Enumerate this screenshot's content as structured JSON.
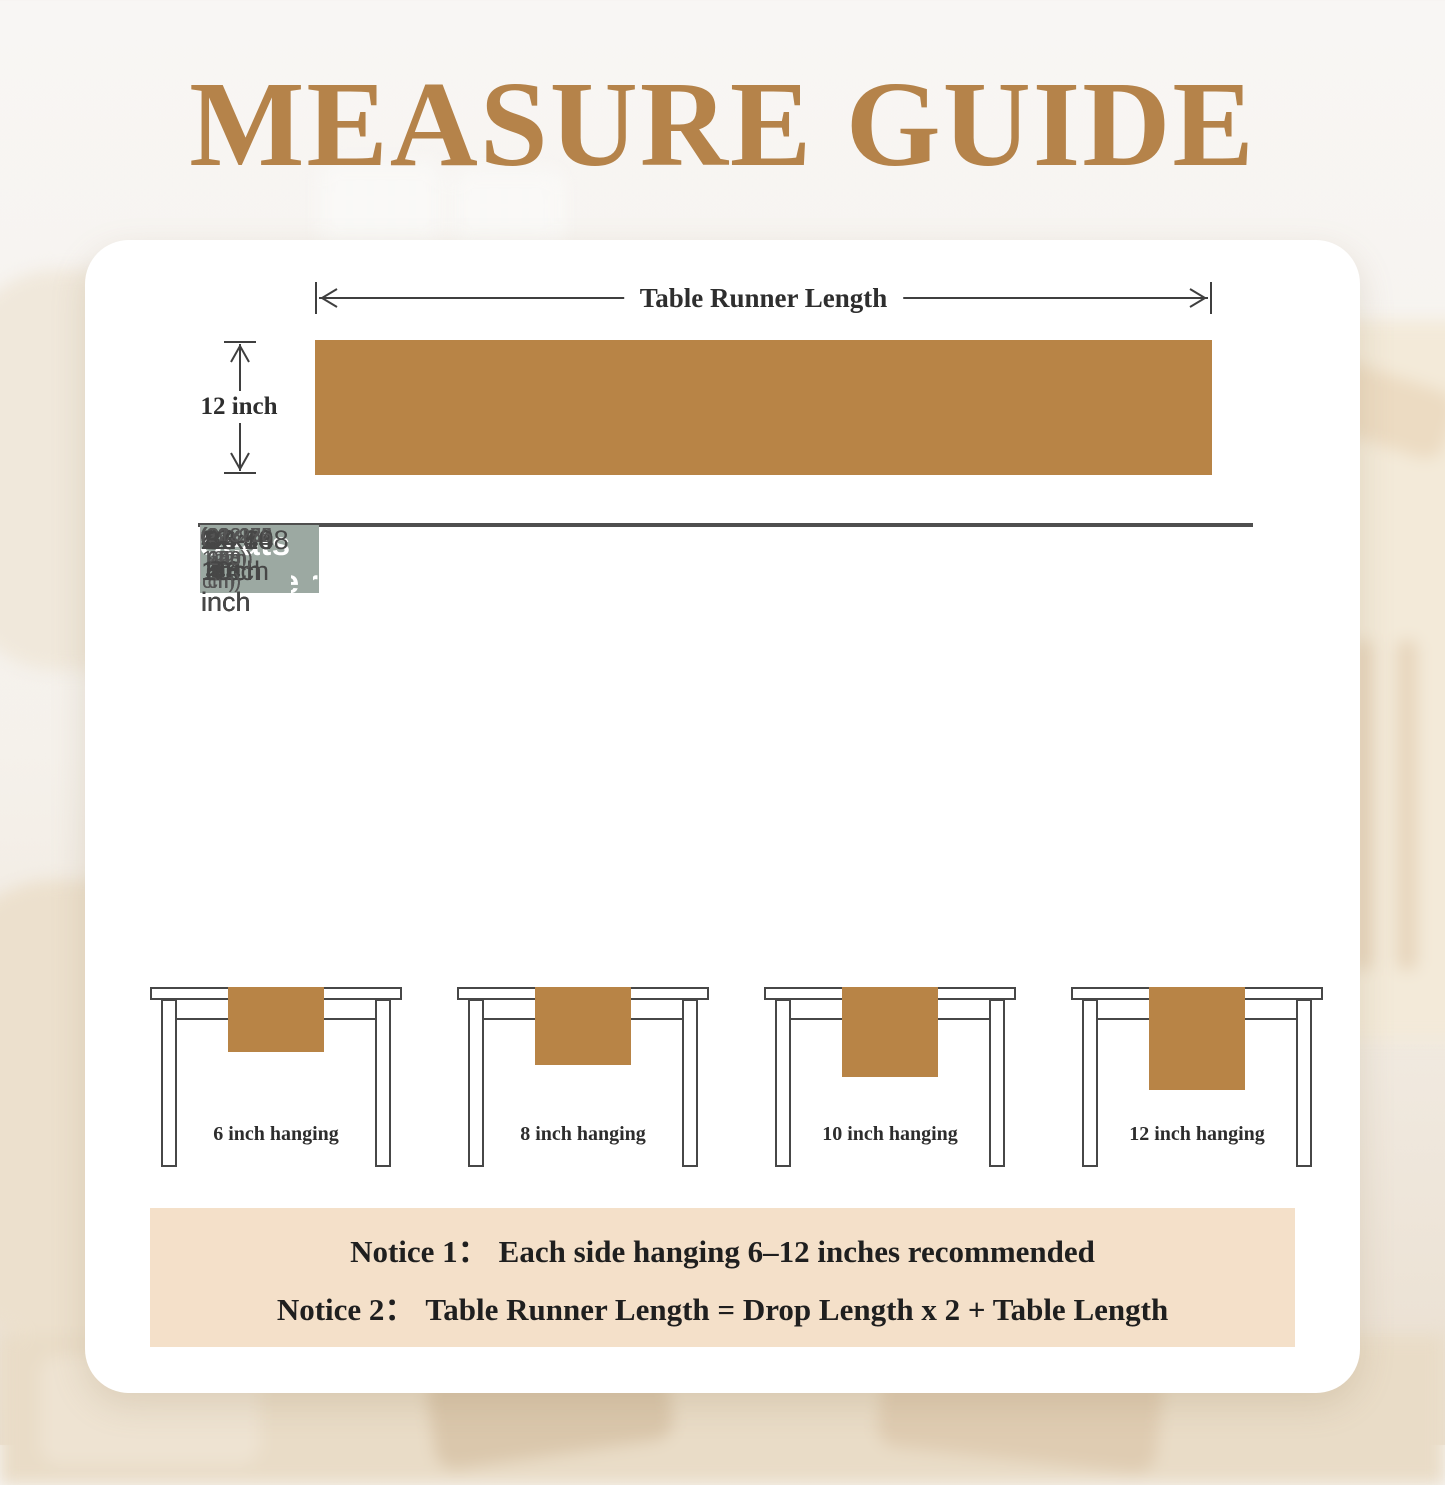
{
  "page": {
    "title": "MEASURE GUIDE"
  },
  "diagram": {
    "length_label": "Table Runner Length",
    "width_label": "12 inch"
  },
  "size_table": {
    "headers": [
      "Table Runner Size",
      "Fit Table Length",
      "Seats"
    ],
    "rows": [
      {
        "size": "12x36 inch",
        "size_cm": "(32x92 cm)",
        "fit": "12-24 inch",
        "fit_cm": "(30-60 cm)",
        "seats": "1-2"
      },
      {
        "size": "12x48 inch",
        "size_cm": "(32x122 cm)",
        "fit": "24-36 inch",
        "fit_cm": "(60-92 cm)",
        "seats": "1-2"
      },
      {
        "size": "12x60 inch",
        "size_cm": "(32x153 cm)",
        "fit": "36-48 inch",
        "fit_cm": "(92-122 cm)",
        "seats": "2-4"
      },
      {
        "size": "12x70 inch",
        "size_cm": "(32x183 cm)",
        "fit": "48-60 inch",
        "fit_cm": "(122-153 cm)",
        "seats": "4-6"
      },
      {
        "size": "12x84 inch",
        "size_cm": "(32x230 cm)",
        "fit": "66-78 inch",
        "fit_cm": "(168-198 cm)",
        "seats": "6-8"
      },
      {
        "size": "12x108 inch",
        "size_cm": "(32x275 cm)",
        "fit": "84-96 inch",
        "fit_cm": "(213-240 cm)",
        "seats": "8-10"
      }
    ]
  },
  "hanging_figures": [
    {
      "label": "6 inch hanging"
    },
    {
      "label": "8 inch hanging"
    },
    {
      "label": "10 inch hanging"
    },
    {
      "label": "12 inch hanging"
    }
  ],
  "notices": [
    {
      "label": "Notice 1：",
      "text": "Each side hanging 6–12 inches recommended"
    },
    {
      "label": "Notice 2：",
      "text": "Table Runner Length = Drop Length x 2 + Table Length"
    }
  ],
  "colors": {
    "accent_brown": "#b5834a",
    "runner_brown": "#b88446",
    "table_header_sage": "#9ca9a2",
    "row_alt_gray": "#e9eaea",
    "notice_beige": "#f4e0c9"
  }
}
